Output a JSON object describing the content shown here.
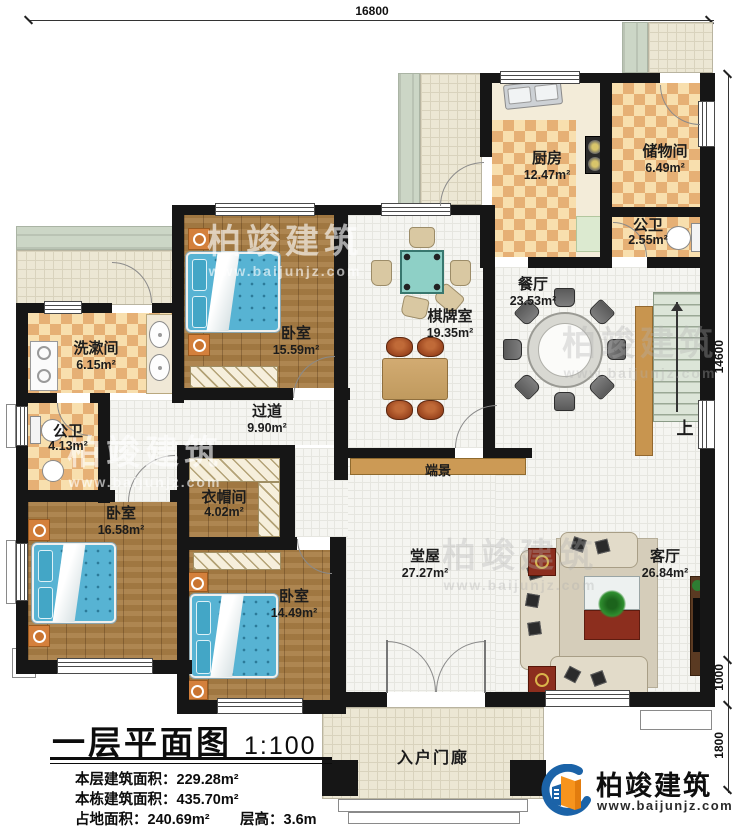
{
  "meta": {
    "title": "一层平面图",
    "scale": "1:100",
    "stats": [
      {
        "label": "本层建筑面积：",
        "value": "229.28m²"
      },
      {
        "label": "本栋建筑面积：",
        "value": "435.70m²"
      },
      {
        "label": "占地面积：",
        "value": "240.69m²"
      },
      {
        "label": "层高：",
        "value": "3.6m"
      }
    ]
  },
  "dimensions": {
    "top": "16800",
    "right_main": "14600",
    "right_mid": "1000",
    "right_bottom": "1800"
  },
  "rooms": [
    {
      "name": "厨房",
      "area": "12.47m²"
    },
    {
      "name": "储物间",
      "area": "6.49m²"
    },
    {
      "name": "公卫",
      "area": "2.55m²"
    },
    {
      "name": "餐厅",
      "area": "23.53m²"
    },
    {
      "name": "棋牌室",
      "area": "19.35m²"
    },
    {
      "name": "卧室",
      "area": "15.59m²"
    },
    {
      "name": "洗漱间",
      "area": "6.15m²"
    },
    {
      "name": "公卫",
      "area": "4.13m²"
    },
    {
      "name": "过道",
      "area": "9.90m²"
    },
    {
      "name": "衣帽间",
      "area": "4.02m²"
    },
    {
      "name": "卧室",
      "area": "16.58m²"
    },
    {
      "name": "卧室",
      "area": "14.49m²"
    },
    {
      "name": "堂屋",
      "area": "27.27m²"
    },
    {
      "name": "客厅",
      "area": "26.84m²"
    }
  ],
  "labels": {
    "console": "端景",
    "stairs_up": "上",
    "porch": "入户门廊"
  },
  "brand": {
    "name": "柏竣建筑",
    "website": "www.baijunjz.com"
  },
  "watermark": {
    "name": "柏竣建筑",
    "website": "www.baijunjz.com"
  },
  "colors": {
    "wall": "#161616",
    "checker_light": "#f8dfae",
    "checker_dark": "#e6b075",
    "wood": "#a87d44",
    "tile": "#f5f5f1",
    "terrace": "#ece7d4",
    "green_band": "#ccd6c6",
    "bed_blue": "#57b3d3",
    "stair_green": "#dce5d8",
    "console_wood": "#cc9a55",
    "brand_blue": "#1b63a8",
    "brand_orange": "#f7941d",
    "accent_red": "#8c2e1e"
  }
}
